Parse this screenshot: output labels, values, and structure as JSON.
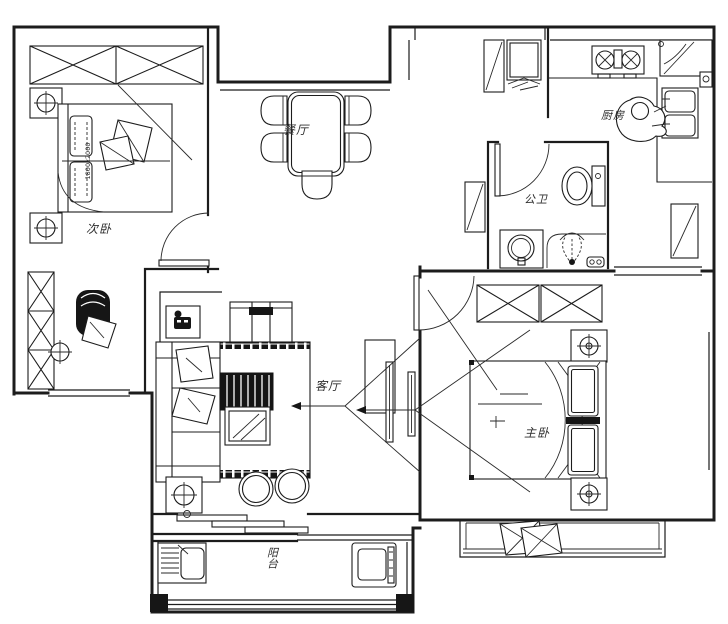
{
  "plan": {
    "type": "apartment-floor-plan",
    "background": "#ffffff",
    "line_color": "#1c1c1c",
    "rooms": {
      "dining": {
        "label": "餐厅"
      },
      "second_bedroom": {
        "label": "次卧",
        "bed_dimension": "1800x2000"
      },
      "bathroom": {
        "label": "公卫"
      },
      "kitchen": {
        "label": "厨房"
      },
      "living": {
        "label": "客厅"
      },
      "master_bedroom": {
        "label": "主卧"
      },
      "balcony": {
        "label": "阳台"
      }
    }
  }
}
